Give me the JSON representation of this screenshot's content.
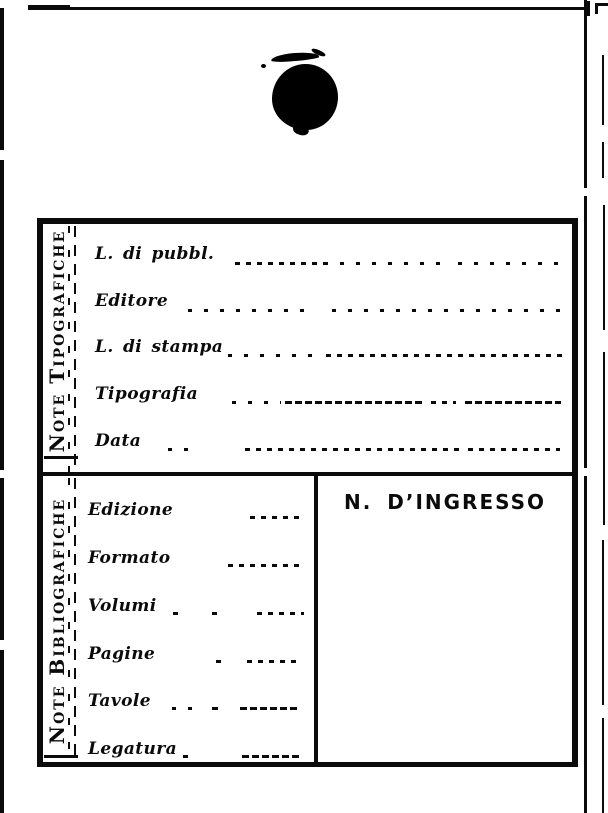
{
  "page": {
    "paper_color": "#ffffff",
    "ink_color": "#0b0b0b"
  },
  "artifacts": {
    "stamp_icon": "ink-blot-stamp"
  },
  "form": {
    "sections": [
      {
        "side_label": "Note Tipografiche",
        "fields": [
          {
            "label": "L. di pubbl."
          },
          {
            "label": "Editore"
          },
          {
            "label": "L. di stampa"
          },
          {
            "label": "Tipografia"
          },
          {
            "label": "Data"
          }
        ]
      },
      {
        "side_label": "Note Bibliografiche",
        "fields": [
          {
            "label": "Edizione"
          },
          {
            "label": "Formato"
          },
          {
            "label": "Volumi"
          },
          {
            "label": "Pagine"
          },
          {
            "label": "Tavole"
          },
          {
            "label": "Legatura"
          }
        ],
        "ingresso_title": "N. D’INGRESSO"
      }
    ]
  }
}
